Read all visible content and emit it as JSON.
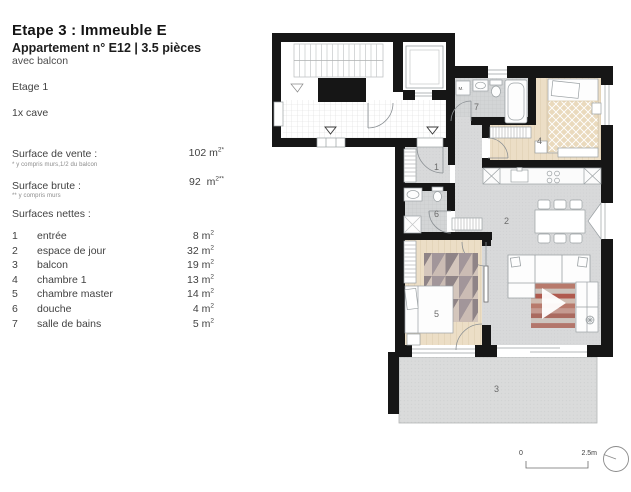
{
  "header": {
    "title": "Etape 3 : Immeuble E",
    "subtitle": "Appartement n° E12 |  3.5 pièces",
    "note": "avec balcon",
    "floor": "Etage 1",
    "storage": "1x cave"
  },
  "units": {
    "base": "m",
    "exp": "2"
  },
  "surfaces": {
    "vente": {
      "label": "Surface de vente :",
      "value": "102",
      "star": "*",
      "footnote": "* y compris murs,1/2 du balcon"
    },
    "brute": {
      "label": "Surface brute :",
      "value": "92",
      "star": "**",
      "footnote": "** y compris murs"
    },
    "nettes_label": "Surfaces nettes :"
  },
  "rooms": [
    {
      "num": "1",
      "name": "entrée",
      "area": "8"
    },
    {
      "num": "2",
      "name": "espace de jour",
      "area": "32"
    },
    {
      "num": "3",
      "name": "balcon",
      "area": "19"
    },
    {
      "num": "4",
      "name": "chambre 1",
      "area": "13"
    },
    {
      "num": "5",
      "name": "chambre master",
      "area": "14"
    },
    {
      "num": "6",
      "name": "douche",
      "area": "4"
    },
    {
      "num": "7",
      "name": "salle de bains",
      "area": "5"
    }
  ],
  "plan": {
    "washing_machine_label": "M.",
    "scale": {
      "from": "0",
      "to": "2.5m"
    }
  },
  "colors": {
    "wall": "#161616",
    "wood_floor": "#ecdec6",
    "gray_floor": "#d8d9da",
    "bath_tile": "#d3d5d6",
    "balcony_floor": "#dadbdb",
    "furniture_line": "#9aa0a3"
  }
}
